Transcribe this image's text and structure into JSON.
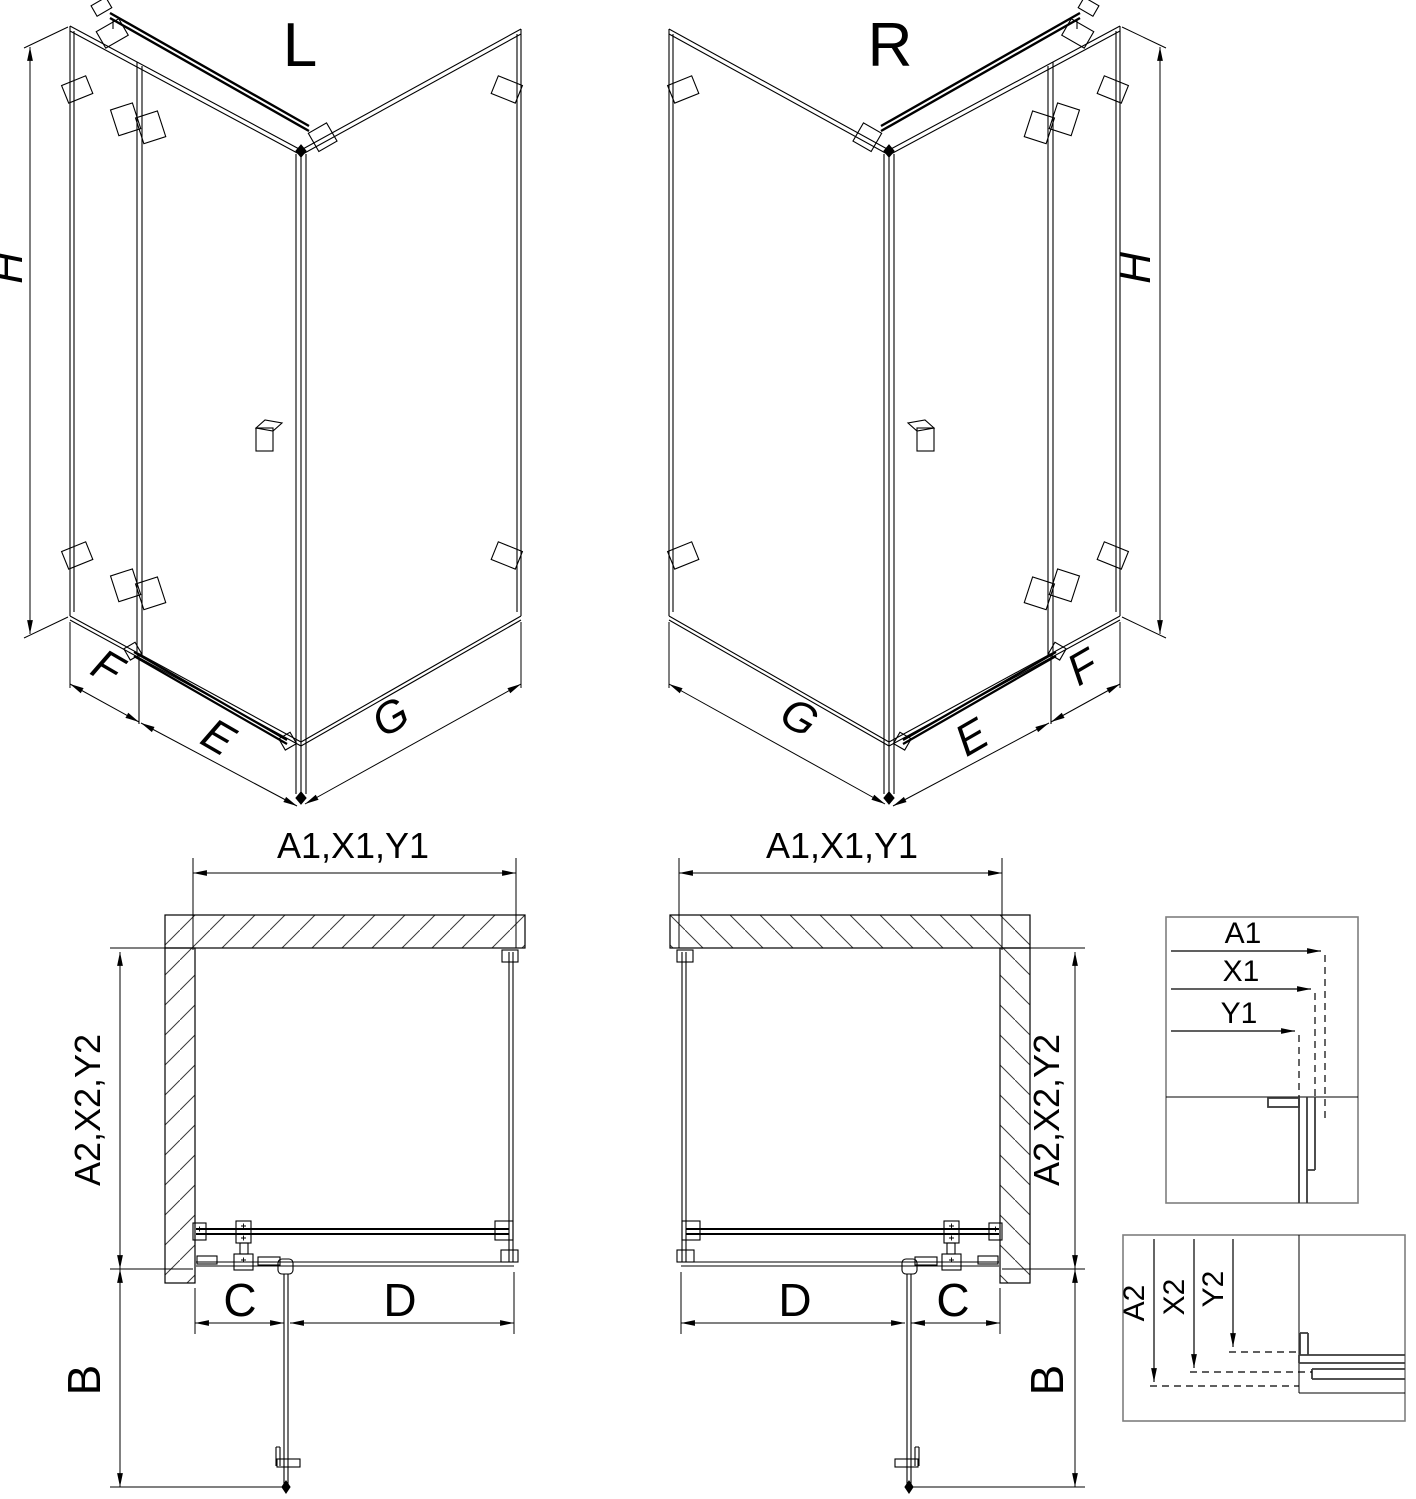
{
  "page": {
    "background": "#ffffff",
    "description": "shower enclosure technical dimension drawing"
  },
  "colors": {
    "line": "#000000",
    "detail_box_border": "#7f7f7f",
    "profile": "#3a3a3a",
    "hatch": "#3a3a3a"
  },
  "views": {
    "iso_left": {
      "label": "L",
      "dim_height": "H",
      "dim_side_panel": "F",
      "dim_door": "E",
      "dim_return_panel": "G"
    },
    "iso_right": {
      "label": "R",
      "dim_height": "H",
      "dim_side_panel": "F",
      "dim_door": "E",
      "dim_return_panel": "G"
    },
    "plan_left": {
      "dim_width": "A1,X1,Y1",
      "dim_depth": "A2,X2,Y2",
      "dim_fixed": "C",
      "dim_door": "D",
      "dim_extension": "B"
    },
    "plan_right": {
      "dim_width": "A1,X1,Y1",
      "dim_depth": "A2,X2,Y2",
      "dim_fixed": "C",
      "dim_door": "D",
      "dim_extension": "B"
    },
    "detail_width": {
      "dims": [
        "A1",
        "X1",
        "Y1"
      ]
    },
    "detail_depth": {
      "dims": [
        "A2",
        "X2",
        "Y2"
      ]
    }
  }
}
